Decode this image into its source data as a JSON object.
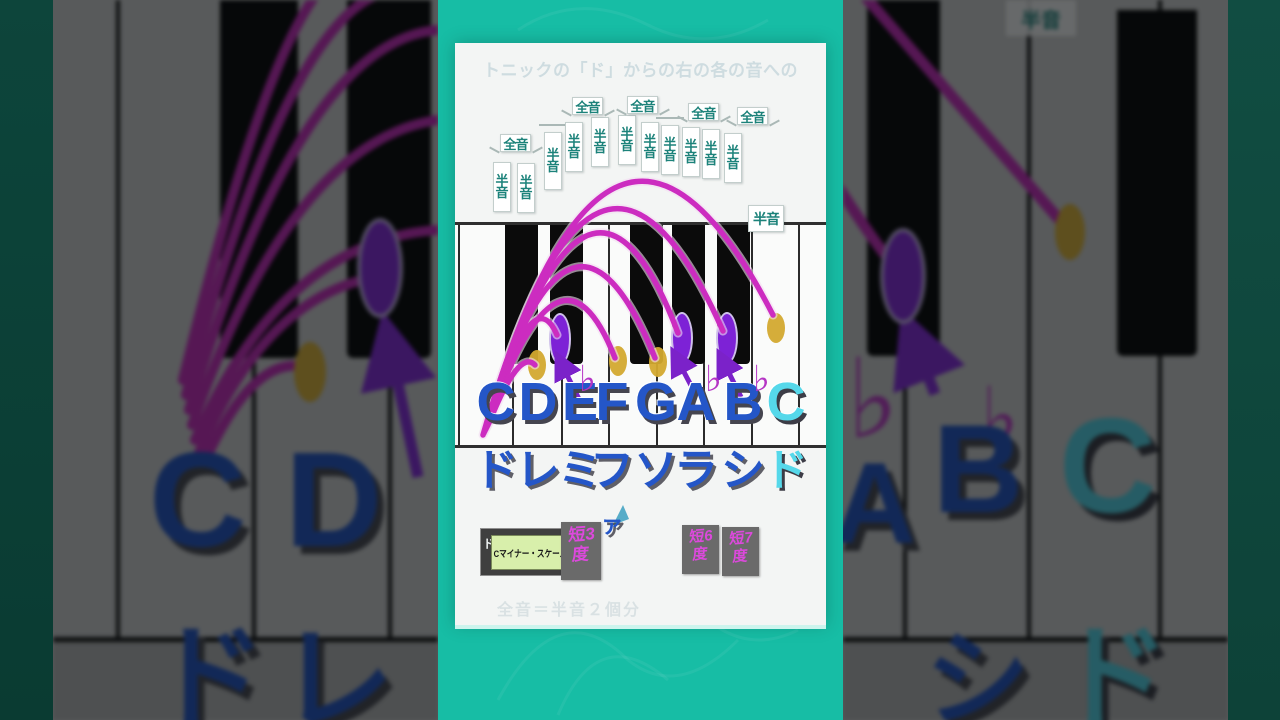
{
  "frame": {
    "faint_title": "トニックの「ド」からの右の各の音への",
    "faint_footnote": "全音＝半音２個分"
  },
  "panel": {
    "interval_labels": {
      "whole": "全音",
      "half": "半音"
    },
    "step_pattern": [
      "whole",
      "half",
      "whole",
      "whole",
      "half",
      "whole",
      "whole"
    ],
    "flat_symbol": "♭",
    "notes": [
      {
        "letter": "C",
        "solfege": "ド",
        "flat": false,
        "accent": false,
        "marker": "origin"
      },
      {
        "letter": "D",
        "solfege": "レ",
        "flat": false,
        "accent": false,
        "marker": "dot"
      },
      {
        "letter": "E",
        "solfege": "ミ",
        "flat": true,
        "accent": false,
        "marker": "ellipse"
      },
      {
        "letter": "F",
        "solfege": "ファ",
        "flat": false,
        "accent": false,
        "marker": "dot"
      },
      {
        "letter": "G",
        "solfege": "ソ",
        "flat": false,
        "accent": false,
        "marker": "dot"
      },
      {
        "letter": "A",
        "solfege": "ラ",
        "flat": true,
        "accent": false,
        "marker": "ellipse"
      },
      {
        "letter": "B",
        "solfege": "シ",
        "flat": true,
        "accent": false,
        "marker": "ellipse"
      },
      {
        "letter": "C",
        "solfege": "ド",
        "flat": false,
        "accent": true,
        "marker": "dot"
      }
    ],
    "scale_box": {
      "prefix": "ド",
      "label": "Cマイナー・スケール"
    },
    "interval_badges": [
      "短3度",
      "短6度",
      "短7度"
    ]
  },
  "side_left": {
    "letters": [
      "C",
      "D"
    ],
    "solfege_partial": [
      "ド",
      "レ"
    ]
  },
  "side_right": {
    "letters": [
      "A",
      "B",
      "C"
    ],
    "flats": [
      "♭",
      "♭"
    ],
    "solfege_partial": [
      "シ",
      "ド"
    ],
    "half_label": "半音"
  },
  "colors": {
    "teal_bg": "#17bda5",
    "panel_bg": "#f3f5f4",
    "note_blue": "#2456c8",
    "accent_cyan": "#55d8ea",
    "arc_magenta": "#cc2cc0",
    "marker_purple": "#8a2be2",
    "marker_gold": "#d9ae35",
    "label_teal": "#1c827a",
    "badge_magenta": "#dc49dc",
    "badge_gray": "#6a6a6a",
    "scale_green": "#d8efab"
  }
}
